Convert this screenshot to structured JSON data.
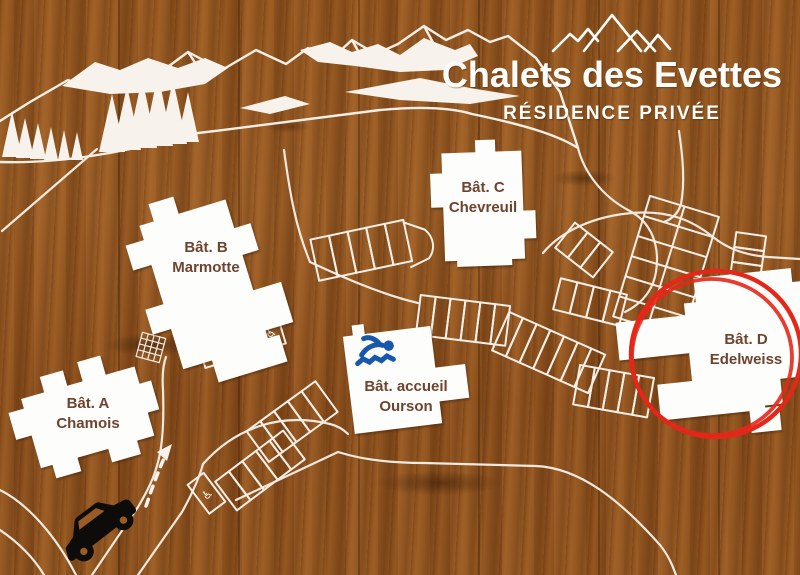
{
  "sign": {
    "title": "Chalets des Evettes",
    "subtitle": "RÉSIDENCE PRIVÉE"
  },
  "buildings": [
    {
      "label": "Bât. A",
      "name": "Chamois"
    },
    {
      "label": "Bât. B",
      "name": "Marmotte"
    },
    {
      "label": "Bât. C",
      "name": "Chevreuil"
    },
    {
      "label": "Bât. D",
      "name": "Edelweiss",
      "highlighted": true
    },
    {
      "label": "Bât. accueil",
      "name": "Ourson",
      "amenity_icon": "swimmer-icon"
    }
  ],
  "map_icons": {
    "logo": "mountains-icon",
    "pool": "swimmer-icon",
    "car": "car-icon",
    "entrance": "dashed-arrow-icon",
    "accessible_parking": "wheelchair-icon"
  },
  "accessible_symbol": "♿",
  "colors": {
    "map_lines": "#f4efe6",
    "building_fill": "#fdfdfc",
    "building_text": "#6e4430",
    "highlight_red": "#e42718",
    "pool_blue": "#1758ad",
    "car_black": "#0e0c0a"
  }
}
